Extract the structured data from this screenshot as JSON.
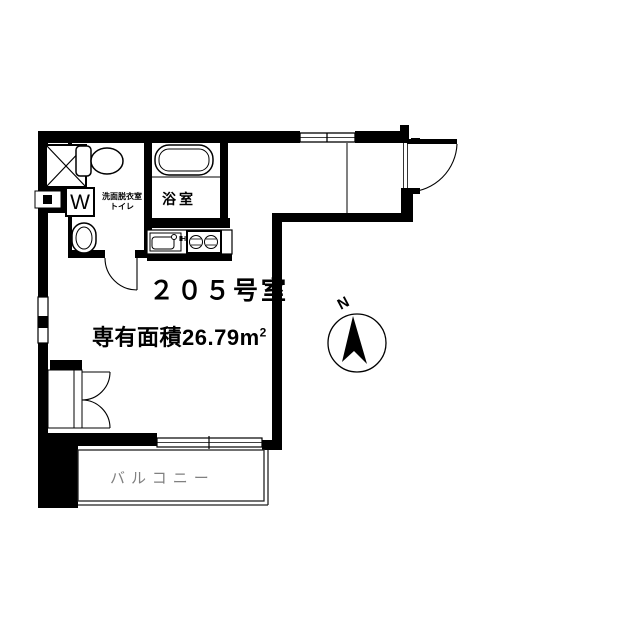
{
  "colors": {
    "wall": "#000000",
    "line": "#1a1a1a",
    "balcony_text": "#808080",
    "background": "#ffffff"
  },
  "plan": {
    "room_number": "２０５号室",
    "area_label": "専有面積26.79",
    "area_unit": "m",
    "area_sup": "2",
    "bathroom_label": "浴室",
    "washroom_label_line1": "洗面脱衣室",
    "washroom_label_line2": "トイレ",
    "balcony_label": "バルコニー",
    "washer_label": "W",
    "stove_label": "IH",
    "compass_north": "N"
  }
}
